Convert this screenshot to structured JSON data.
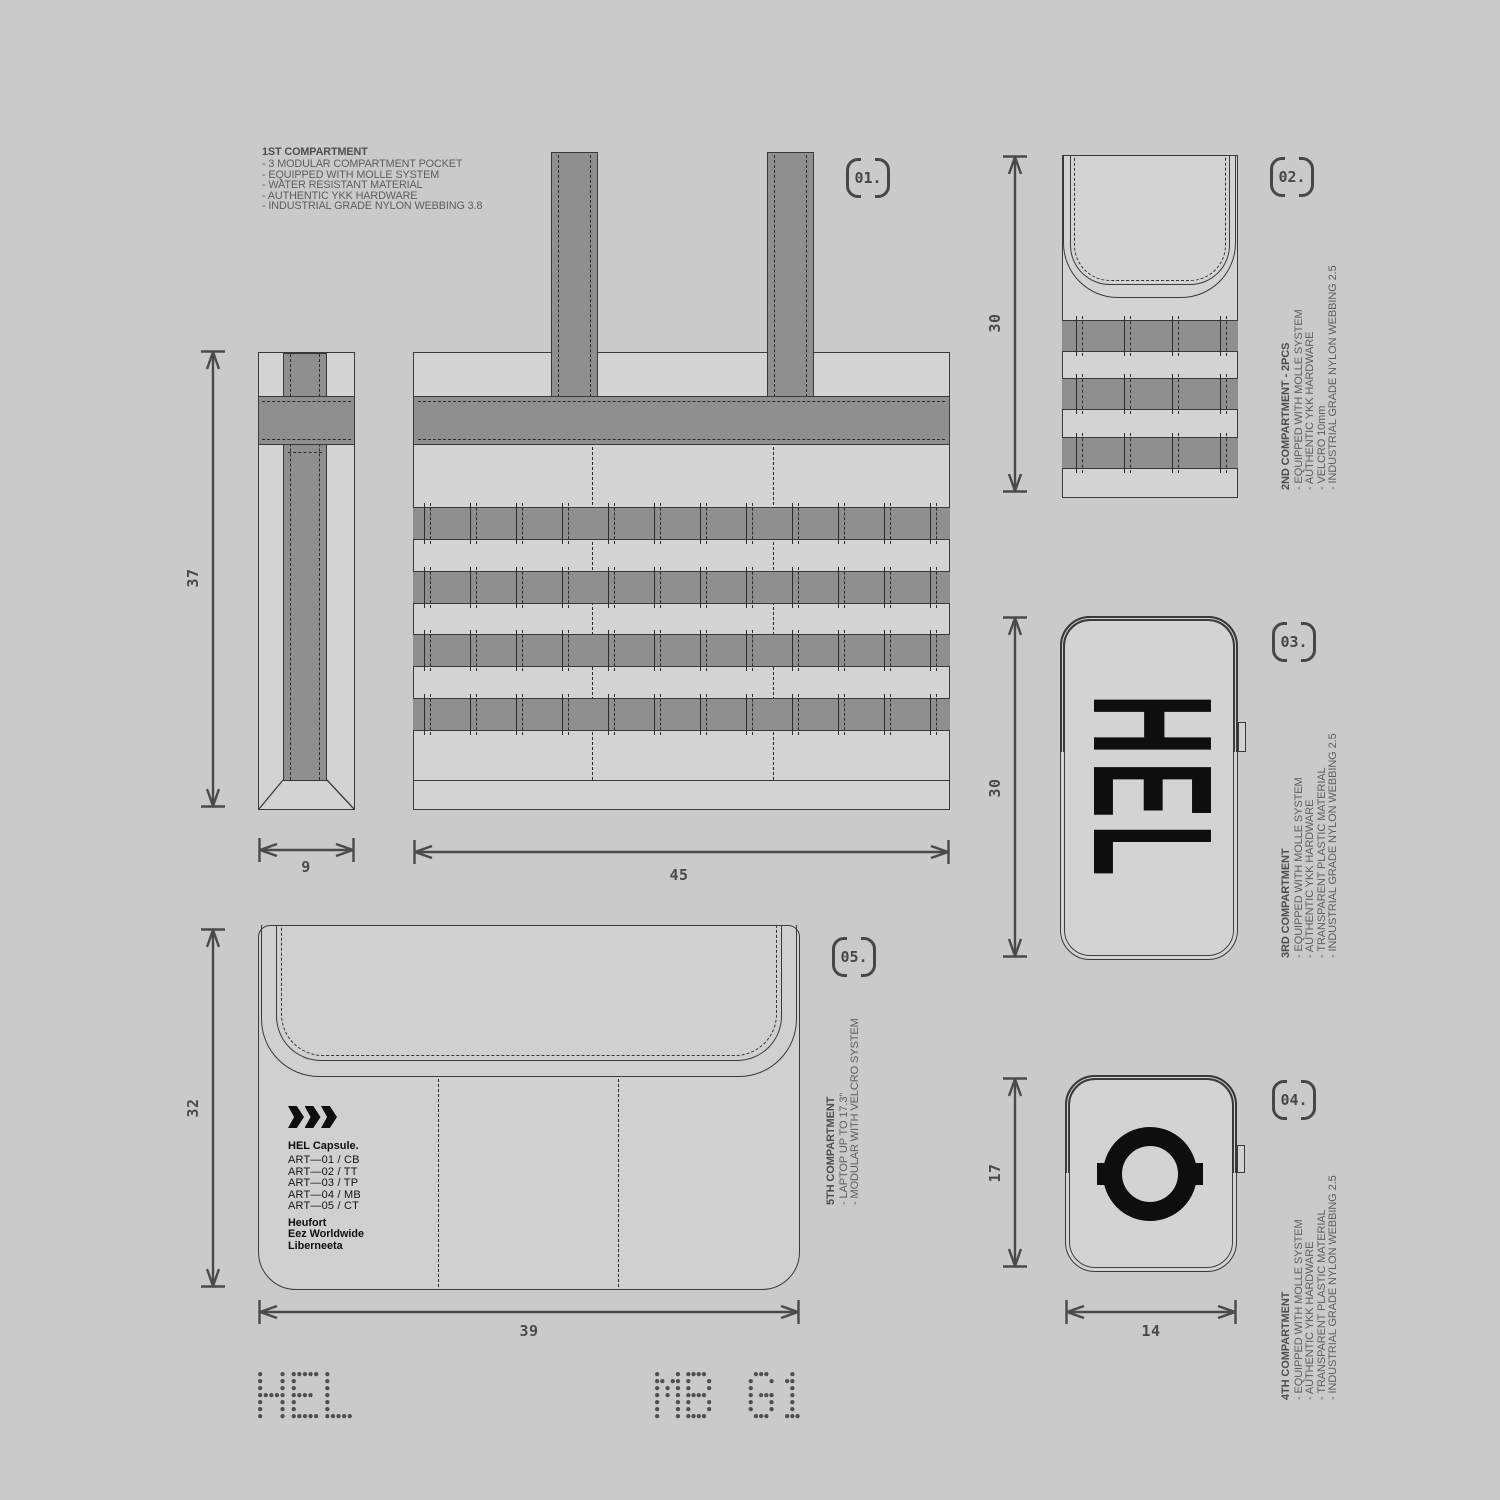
{
  "compartments": [
    {
      "id": "01.",
      "title": "1ST COMPARTMENT",
      "bullets": [
        "- 3 MODULAR COMPARTMENT POCKET",
        "- EQUIPPED WITH MOLLE SYSTEM",
        "- WATER RESISTANT MATERIAL",
        "- AUTHENTIC YKK HARDWARE",
        "- INDUSTRIAL GRADE NYLON WEBBING 3.8"
      ]
    },
    {
      "id": "02.",
      "title": "2ND COMPARTMENT - 2PCS",
      "bullets": [
        "- EQUIPPED WITH MOLLE SYSTEM",
        "- AUTHENTIC YKK HARDWARE",
        "- VELCRO 10mm",
        "- INDUSTRIAL GRADE NYLON WEBBING 2.5"
      ]
    },
    {
      "id": "03.",
      "title": "3RD COMPARTMENT",
      "bullets": [
        "- EQUIPPED WITH MOLLE SYSTEM",
        "- AUTHENTIC YKK HARDWARE",
        "- TRANSPARENT PLASTIC MATERIAL",
        "- INDUSTRIAL GRADE NYLON WEBBING 2.5"
      ]
    },
    {
      "id": "04.",
      "title": "4TH COMPARTMENT",
      "bullets": [
        "- EQUIPPED WITH MOLLE SYSTEM",
        "- AUTHENTIC YKK HARDWARE",
        "- TRANSPARENT PLASTIC MATERIAL",
        "- INDUSTRIAL GRADE NYLON WEBBING 2.5"
      ]
    },
    {
      "id": "05.",
      "title": "5TH COMPARTMENT",
      "bullets": [
        "- LAPTOP UP TO 17.3\"",
        "- MODULAR WITH VELCRO SYSTEM"
      ]
    }
  ],
  "dimensions": {
    "side_height": "37",
    "side_width": "9",
    "front_width": "45",
    "comp2_height": "30",
    "comp3_height": "30",
    "comp4_height": "17",
    "comp4_width": "14",
    "sleeve_height": "32",
    "sleeve_width": "39"
  },
  "sleeve_label": {
    "brand": "HEL Capsule.",
    "articles": [
      "ART—01 / CB",
      "ART—02 / TT",
      "ART—03 / TP",
      "ART—04 / MB",
      "ART—05 / CT"
    ],
    "names": [
      "Heufort",
      "Eez Worldwide",
      "Liberneeta"
    ]
  },
  "logos": {
    "comp3_text": "HEL",
    "comp4_text": "O"
  },
  "footer": {
    "left": "HEL",
    "right": "MB G1"
  },
  "colors": {
    "background": "#c9cac9",
    "panel": "#d2d3d2",
    "webbing": "#8e8f8e",
    "line": "#3a3a3a",
    "ink": "#0e0e0e",
    "gray_text": "#5d5d5d",
    "dim": "#4a4a4a"
  }
}
